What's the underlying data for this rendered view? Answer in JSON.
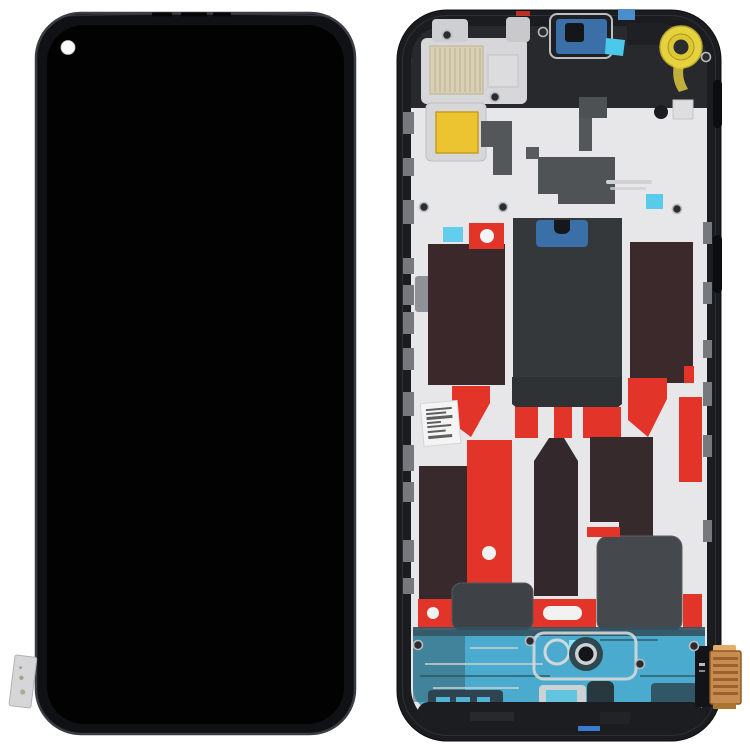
{
  "scene": {
    "description": "Product photo of a phone LCD screen and digitizer full assembly with frame, front view on the left and rear frame view on the right, on a white background",
    "background_color": "#ffffff"
  },
  "colors": {
    "background": "#ffffff",
    "frame_black": "#1b1c20",
    "bezel_edge": "#3a3c42",
    "screen_black": "#020203",
    "punch_hole_white": "#fafafa",
    "midplate_silver": "#e7e7e9",
    "silver_dark": "#cfcfd2",
    "top_cavity_dark": "#28292d",
    "graphite_gray": "#54575a",
    "graphite_dark": "#35383b",
    "adhesive_red": "#e23428",
    "film_maroon": "#3a282b",
    "sticker_cyan": "#4cc9ea",
    "camera_bracket_blue": "#3a6fa8",
    "tab_blue": "#4a8ccc",
    "lens_ring_yellow": "#e6d23e",
    "contact_pad_gold": "#ecc431",
    "mesh_beige": "#d9cfb4",
    "bottom_teal": "#4aabce",
    "slate_dark": "#2e4750",
    "connector_copper": "#c98c50",
    "connector_copper_dark": "#8a5322",
    "label_white": "#f4f4f4",
    "gray_rect": "#45494d",
    "screw_dark": "#2b2c30",
    "screw_rim": "#b9bcbe"
  },
  "parts": {
    "front_assembly": {
      "label": "front LCD assembly, black screen with punch-hole camera cutout top-left and flex tab on lower-left edge"
    },
    "rear_assembly": {
      "label": "rear mid-frame with silver plate, red adhesive, graphite films, yellow lens ring, blue camera bracket, teal bottom chassis and copper flex connector"
    }
  }
}
